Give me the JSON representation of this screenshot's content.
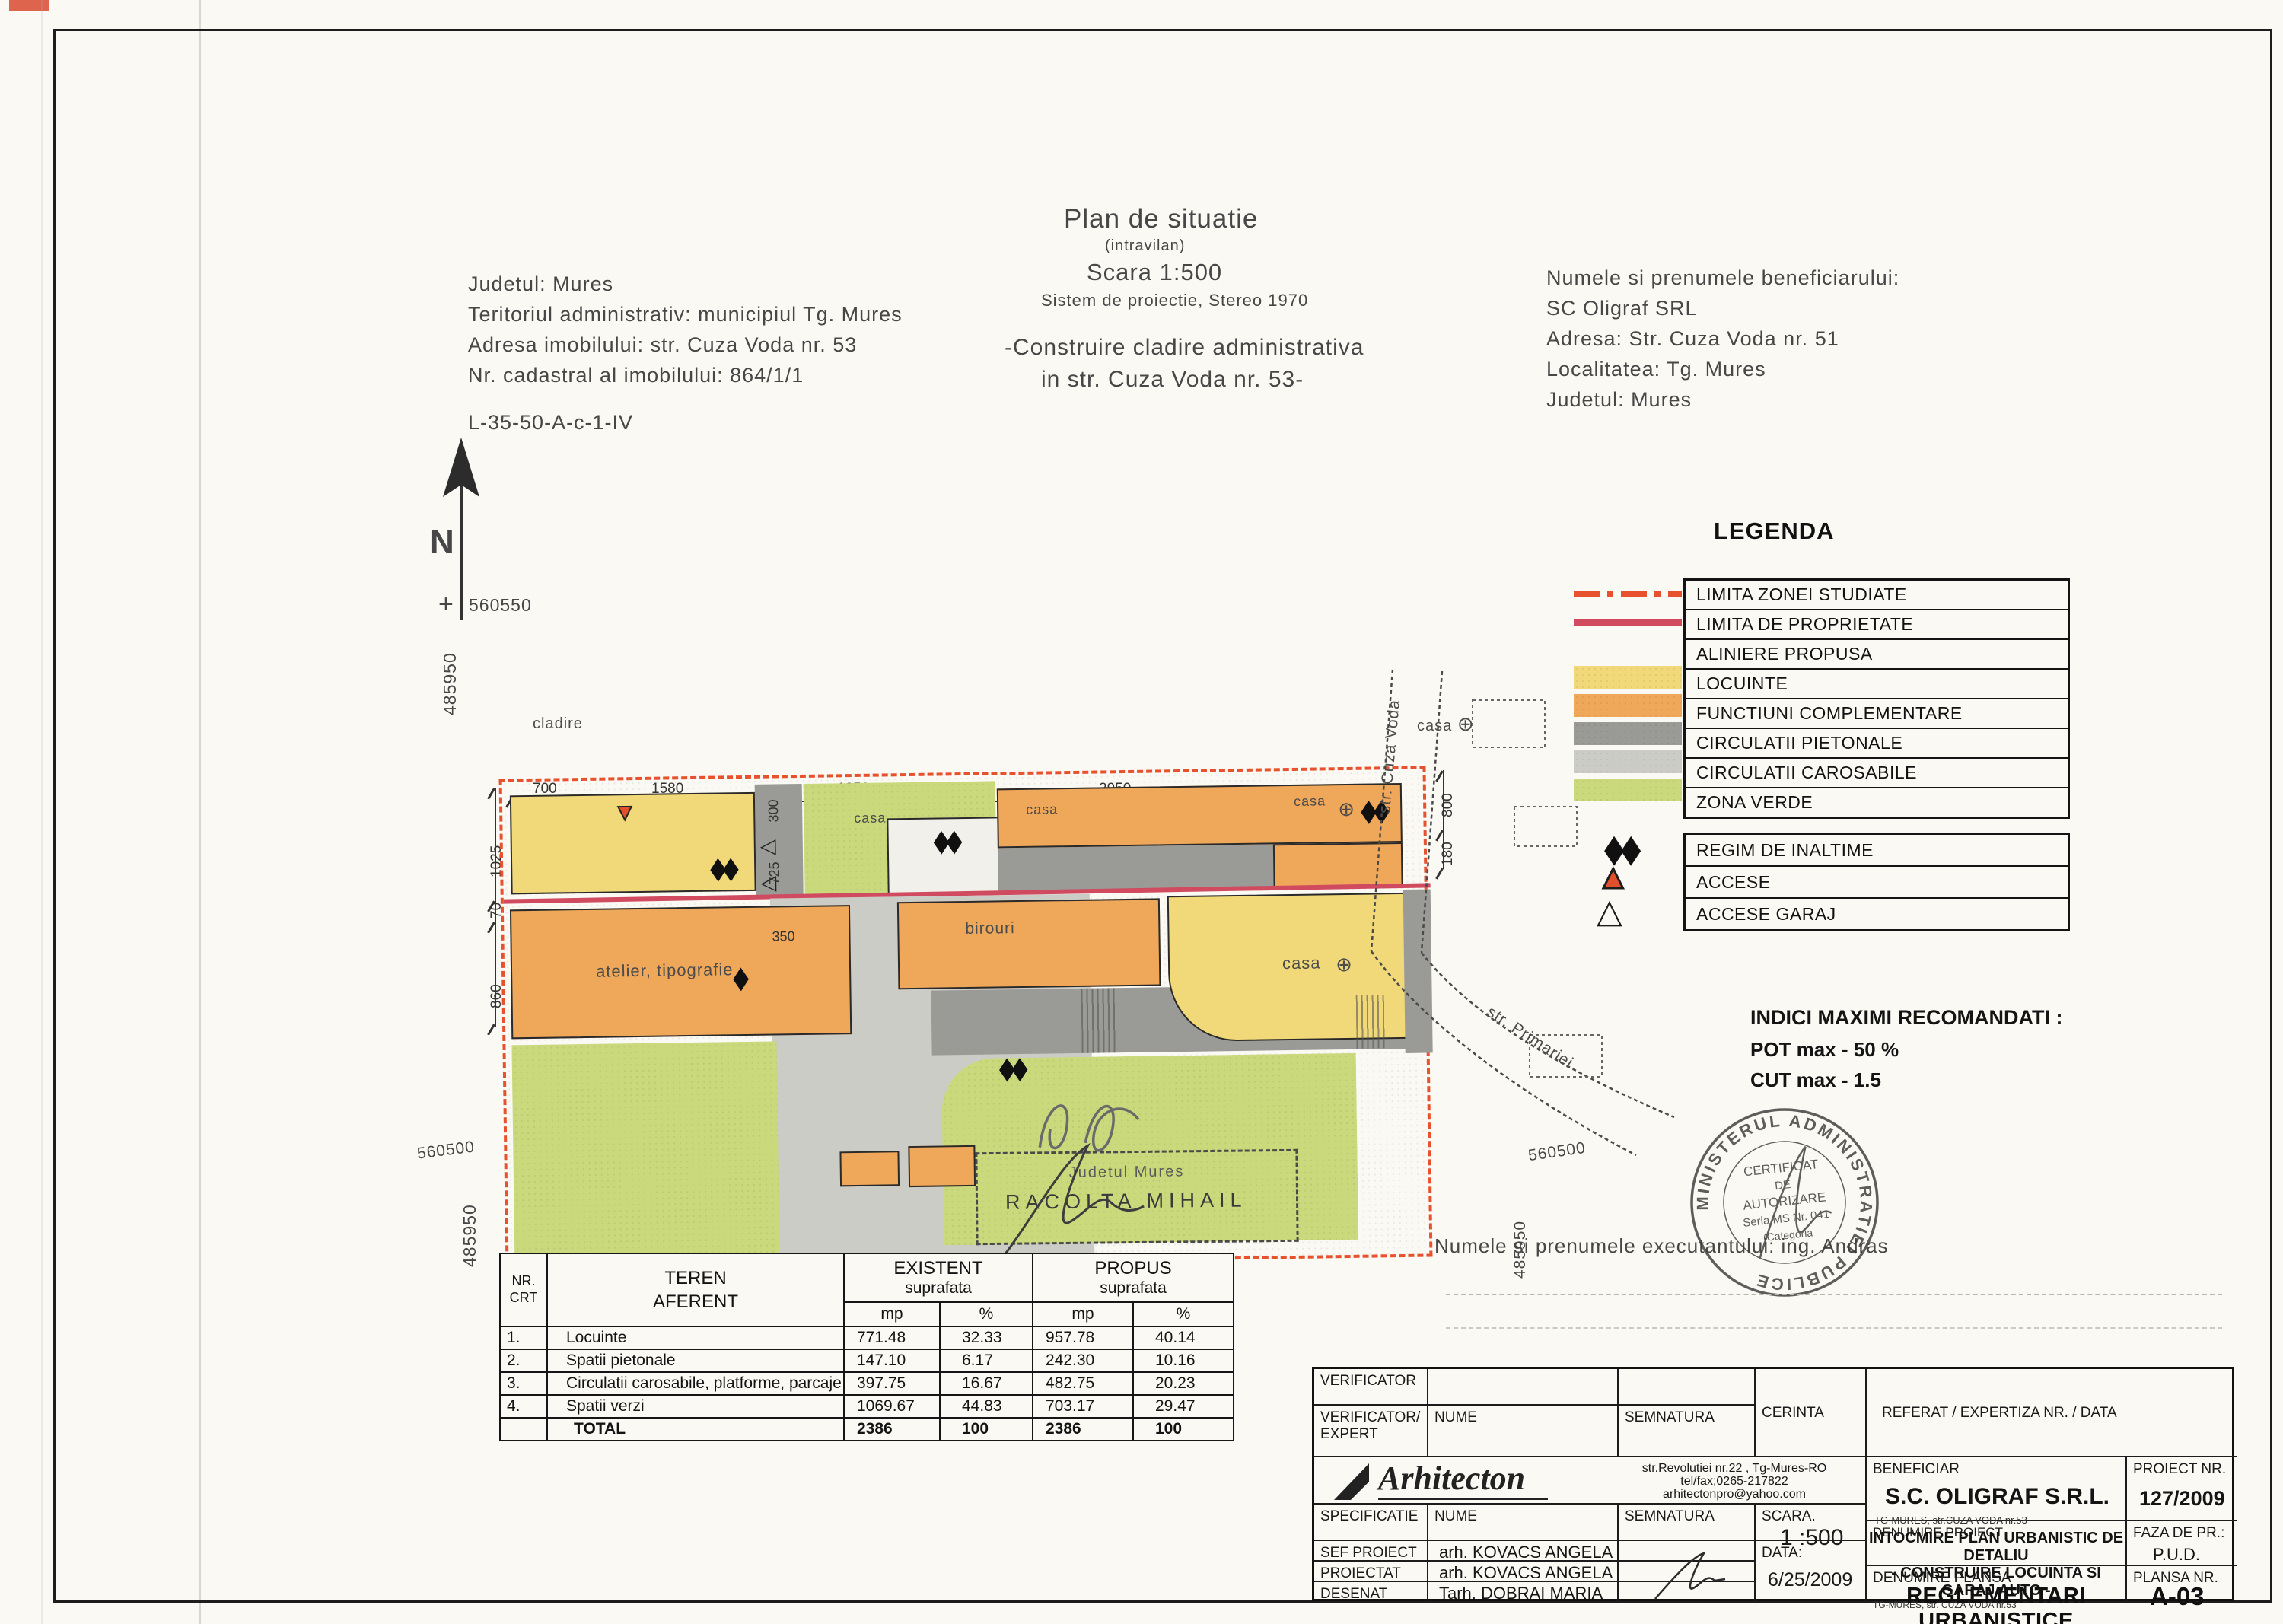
{
  "colors": {
    "locuinte": "#f1d879",
    "functiuni": "#efa75a",
    "pietonale": "#9a9a96",
    "carosabile": "#ccccc6",
    "verde": "#c9d97b",
    "limita_zona": "#e8512e",
    "limita_prop": "#d04a60",
    "whitebldg": "#f1f0ea"
  },
  "header_left": {
    "lines": [
      "Judetul: Mures",
      "Teritoriul administrativ: municipiul Tg. Mures",
      "Adresa imobilului: str. Cuza Voda nr. 53",
      "Nr. cadastral al imobilului: 864/1/1"
    ],
    "code": "L-35-50-A-c-1-IV"
  },
  "title_center": {
    "title": "Plan de situatie",
    "subtitle": "(intravilan)",
    "scale": "Scara 1:500",
    "projection": "Sistem de proiectie, Stereo 1970",
    "line1": "-Construire cladire administrativa",
    "line2": "in str. Cuza Voda nr. 53-"
  },
  "header_right": {
    "lines": [
      "Numele si prenumele beneficiarului:",
      "SC Oligraf SRL",
      "Adresa: Str. Cuza Voda nr. 51",
      "Localitatea: Tg. Mures",
      "Judetul: Mures"
    ]
  },
  "legend": {
    "title": "LEGENDA",
    "items": [
      {
        "label": "LIMITA ZONEI STUDIATE",
        "type": "dashdot"
      },
      {
        "label": "LIMITA DE PROPRIETATE",
        "type": "solid"
      },
      {
        "label": "ALINIERE PROPUSA",
        "type": "none"
      },
      {
        "label": "LOCUINTE",
        "type": "fill"
      },
      {
        "label": "FUNCTIUNI COMPLEMENTARE",
        "type": "fill"
      },
      {
        "label": "CIRCULATII PIETONALE",
        "type": "fill"
      },
      {
        "label": "CIRCULATII CAROSABILE",
        "type": "fill"
      },
      {
        "label": "ZONA VERDE",
        "type": "fill"
      }
    ],
    "symbol_items": [
      {
        "label": "REGIM DE INALTIME",
        "symbol": "diamonds"
      },
      {
        "label": "ACCESE",
        "symbol": "triangle-filled"
      },
      {
        "label": "ACCESE GARAJ",
        "symbol": "triangle-outline"
      }
    ]
  },
  "indici": {
    "title": "INDICI MAXIMI RECOMANDATI :",
    "pot": "POT max - 50 %",
    "cut": "CUT max   -   1.5"
  },
  "plan": {
    "north": "N",
    "coords": {
      "cross": "560550",
      "left": "485950",
      "left_bottom": "485950",
      "bottom_left": "560500",
      "right": "560500",
      "right_v": "485950"
    },
    "streets": {
      "cuza": "str. Cuza Voda",
      "primariei": "str. Primariei"
    },
    "labels": {
      "cladire": "cladire",
      "casa": "casa",
      "atelier": "atelier, tipografie",
      "birouri": "birouri",
      "circle": "⊕"
    },
    "dims": {
      "d700": "700",
      "d1580": "1580",
      "d1850": "1850",
      "d2950": "2950",
      "d1025": "1025",
      "d70": "70",
      "d860": "860",
      "d300": "300",
      "d725": "725",
      "d350": "350",
      "d800": "800",
      "d180": "180"
    }
  },
  "stamp_box": {
    "line1": "Judetul Mures",
    "name": "RACOLTA MIHAIL"
  },
  "round_stamp": {
    "ring": "MINISTERUL  ADMINISTRATIEI  PUBLICE",
    "l1": "CERTIFICAT",
    "l2": "DE",
    "l3": "AUTORIZARE",
    "l4": "Seria MS Nr. 041",
    "l5": "(Categoria"
  },
  "executant": "Numele si prenumele executantului: ing. Andras",
  "areas_table": {
    "h": {
      "nr1": "NR.",
      "nr2": "CRT",
      "teren1": "TEREN",
      "teren2": "AFERENT",
      "existent": "EXISTENT",
      "propus": "PROPUS",
      "suprafata": "suprafata",
      "mp": "mp",
      "pct": "%"
    },
    "rows": [
      {
        "nr": "1.",
        "name": "Locuinte",
        "emp": "771.48",
        "epct": "32.33",
        "pmp": "957.78",
        "ppct": "40.14"
      },
      {
        "nr": "2.",
        "name": "Spatii pietonale",
        "emp": "147.10",
        "epct": "6.17",
        "pmp": "242.30",
        "ppct": "10.16"
      },
      {
        "nr": "3.",
        "name": "Circulatii carosabile, platforme, parcaje",
        "emp": "397.75",
        "epct": "16.67",
        "pmp": "482.75",
        "ppct": "20.23"
      },
      {
        "nr": "4.",
        "name": "Spatii verzi",
        "emp": "1069.67",
        "epct": "44.83",
        "pmp": "703.17",
        "ppct": "29.47"
      }
    ],
    "total": {
      "nr": "",
      "name": "TOTAL",
      "emp": "2386",
      "epct": "100",
      "pmp": "2386",
      "ppct": "100"
    }
  },
  "title_block": {
    "verificator": "VERIFICATOR",
    "verificator_expert1": "VERIFICATOR/",
    "verificator_expert2": "EXPERT",
    "nume": "NUME",
    "semnatura": "SEMNATURA",
    "cerinta": "CERINTA",
    "referat": "REFERAT / EXPERTIZA NR. / DATA",
    "logo": "Arhitecton",
    "addr1": "str.Revolutiei nr.22 , Tg-Mures-RO",
    "addr2": "tel/fax;0265-217822",
    "addr3": "arhitectonpro@yahoo.com",
    "beneficiar_label": "BENEFICIAR",
    "beneficiar": "S.C. OLIGRAF S.R.L.",
    "beneficiar_sub": "TG-MURES, str.CUZA VODA nr.53",
    "proiect_nr_label": "PROIECT NR.",
    "proiect_nr": "127/2009",
    "specificatie": "SPECIFICATIE",
    "scara_label": "SCARA.",
    "scara": "1 :500",
    "denumire_proiect_label": "DENUMIRE PROIECT",
    "denumire_proiect1": "INTOCMIRE PLAN URBANISTIC DE DETALIU",
    "denumire_proiect2": "- CONSTRUIRE LOCUINTA SI GARAJ AUTO -",
    "denumire_proiect_sub": "TG-MURES, str. CUZA VODA nr.53",
    "faza_label": "FAZA DE PR.:",
    "faza": "P.U.D.",
    "sef_proiect": "SEF PROIECT",
    "proiectat": "PROIECTAT",
    "desenat": "DESENAT",
    "sef_name": "arh. KOVACS ANGELA",
    "proiectat_name": "arh. KOVACS ANGELA",
    "desenat_name": "Tarh. DOBRAI MARIA",
    "data_label": "DATA:",
    "data": "6/25/2009",
    "denumire_plansa_label": "DENUMIRE PLANSA",
    "denumire_plansa": "REGLEMENTARI URBANISTICE",
    "plansa_nr_label": "PLANSA NR.",
    "plansa_nr": "A-03"
  }
}
